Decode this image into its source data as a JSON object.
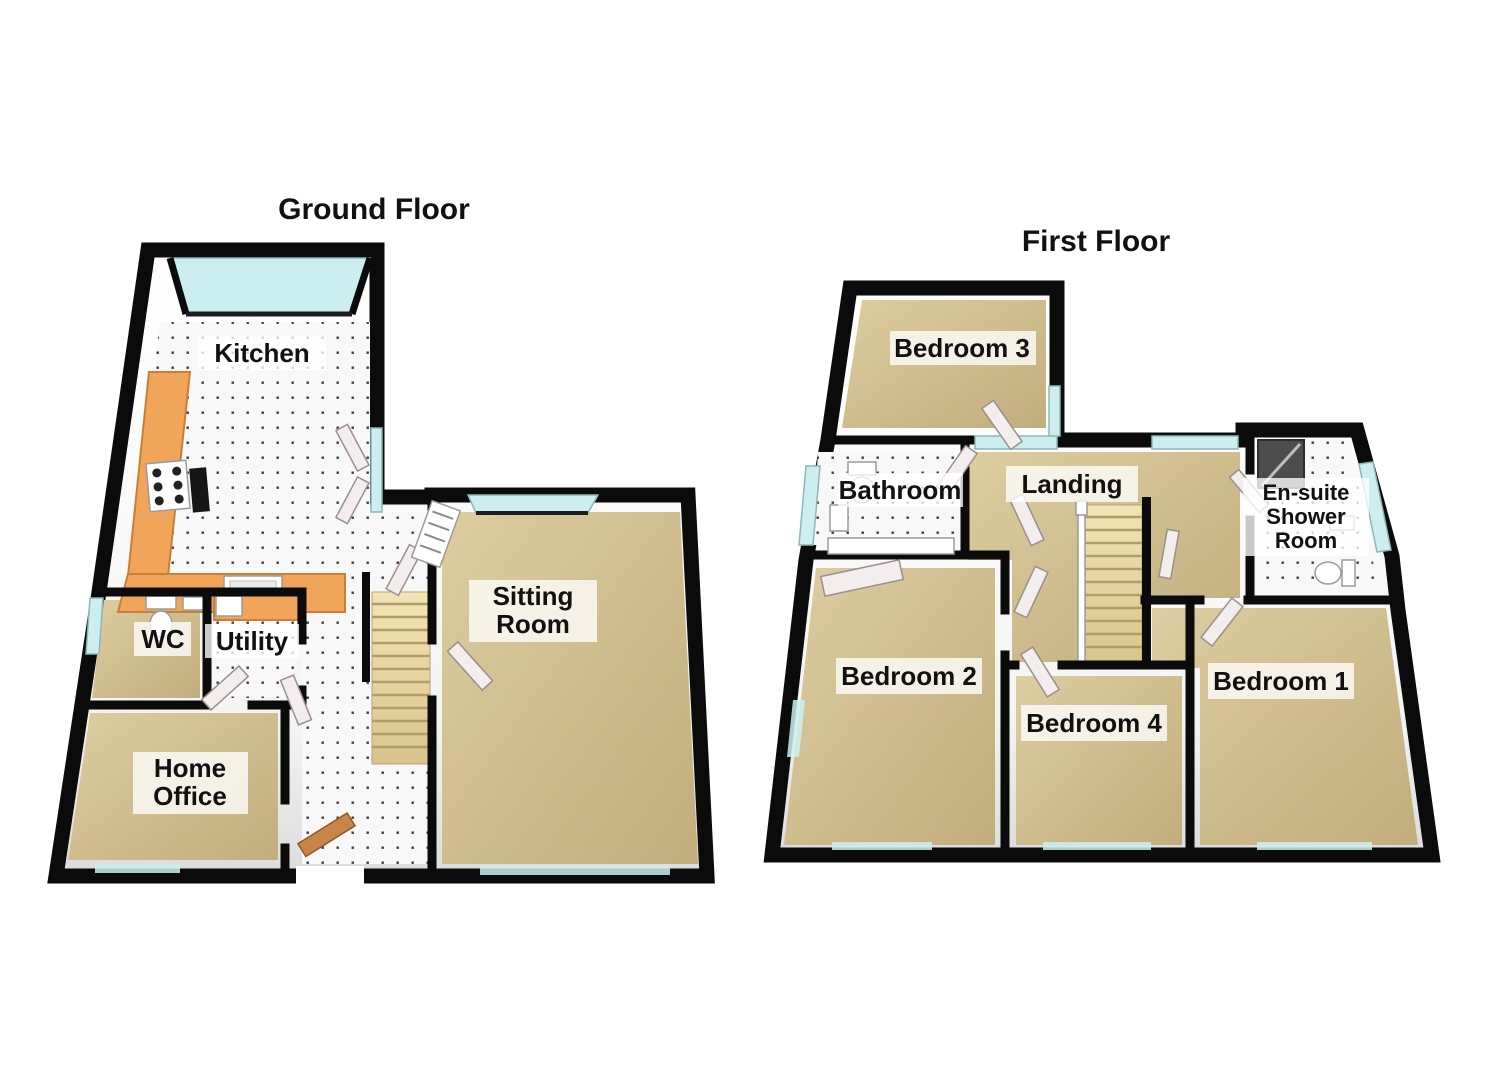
{
  "ground_floor": {
    "title": "Ground Floor",
    "rooms": {
      "kitchen": "Kitchen",
      "wc": "WC",
      "utility": "Utility",
      "home_office": {
        "line1": "Home",
        "line2": "Office"
      },
      "sitting_room": {
        "line1": "Sitting",
        "line2": "Room"
      }
    }
  },
  "first_floor": {
    "title": "First Floor",
    "rooms": {
      "bedroom3": "Bedroom 3",
      "bathroom": "Bathroom",
      "landing": "Landing",
      "ensuite": {
        "line1": "En-suite",
        "line2": "Shower",
        "line3": "Room"
      },
      "bedroom2": "Bedroom 2",
      "bedroom4": "Bedroom 4",
      "bedroom1": "Bedroom 1"
    }
  },
  "colors": {
    "wall": "#0b0b0b",
    "carpet": "#ddcda0",
    "carpetDark": "#c2ad7d",
    "tileDot": "#3c3c3c",
    "counter": "#f0a55a",
    "counterEdge": "#c97f35",
    "stairLight": "#f2e4b4",
    "stairDark": "#d9c48e",
    "window": "#cdeef0",
    "door": "#f3eded",
    "frontDoor": "#c8854a",
    "shower": "#4d4d4d"
  }
}
